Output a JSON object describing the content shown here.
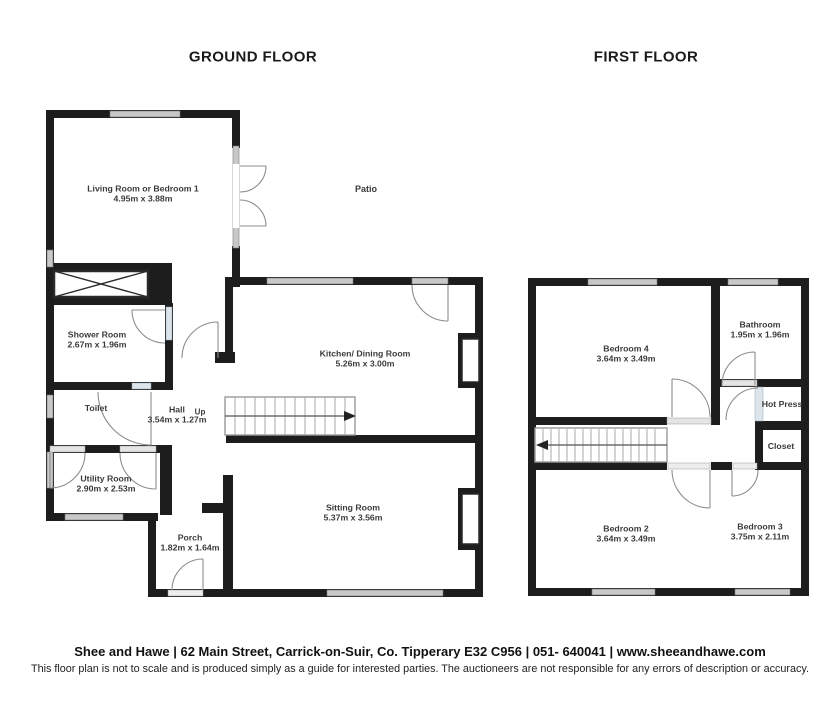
{
  "ground_floor": {
    "title": "GROUND FLOOR",
    "patio_label": "Patio",
    "up_label": "Up",
    "rooms": [
      {
        "id": "living-room",
        "name": "Living Room or Bedroom 1",
        "dims": "4.95m x 3.88m"
      },
      {
        "id": "shower-room",
        "name": "Shower Room",
        "dims": "2.67m x 1.96m"
      },
      {
        "id": "toilet",
        "name": "Toilet",
        "dims": ""
      },
      {
        "id": "hall",
        "name": "Hall",
        "dims": "3.54m x 1.27m"
      },
      {
        "id": "utility-room",
        "name": "Utility Room",
        "dims": "2.90m x 2.53m"
      },
      {
        "id": "porch",
        "name": "Porch",
        "dims": "1.82m x 1.64m"
      },
      {
        "id": "kitchen",
        "name": "Kitchen/ Dining Room",
        "dims": "5.26m x 3.00m"
      },
      {
        "id": "sitting-room",
        "name": "Sitting Room",
        "dims": "5.37m x 3.56m"
      }
    ]
  },
  "first_floor": {
    "title": "FIRST FLOOR",
    "rooms": [
      {
        "id": "bedroom-4",
        "name": "Bedroom 4",
        "dims": "3.64m x 3.49m"
      },
      {
        "id": "bathroom",
        "name": "Bathroom",
        "dims": "1.95m x 1.96m"
      },
      {
        "id": "hot-press",
        "name": "Hot Press",
        "dims": ""
      },
      {
        "id": "closet",
        "name": "Closet",
        "dims": ""
      },
      {
        "id": "bedroom-2",
        "name": "Bedroom 2",
        "dims": "3.64m x 3.49m"
      },
      {
        "id": "bedroom-3",
        "name": "Bedroom 3",
        "dims": "3.75m x 2.11m"
      }
    ]
  },
  "footer": {
    "agency_line": "Shee and Hawe | 62 Main Street, Carrick-on-Suir, Co. Tipperary E32 C956  |  051- 640041  | www.sheeandhawe.com",
    "disclaimer": "This floor plan is not to scale and is produced simply as a guide for interested parties. The auctioneers are not responsible for any errors of description or accuracy."
  },
  "colors": {
    "wall": "#1d1d1d",
    "window": "#c8c8c8",
    "door_strip": "#dde5ec",
    "door_arc": "#8c8c8c"
  }
}
